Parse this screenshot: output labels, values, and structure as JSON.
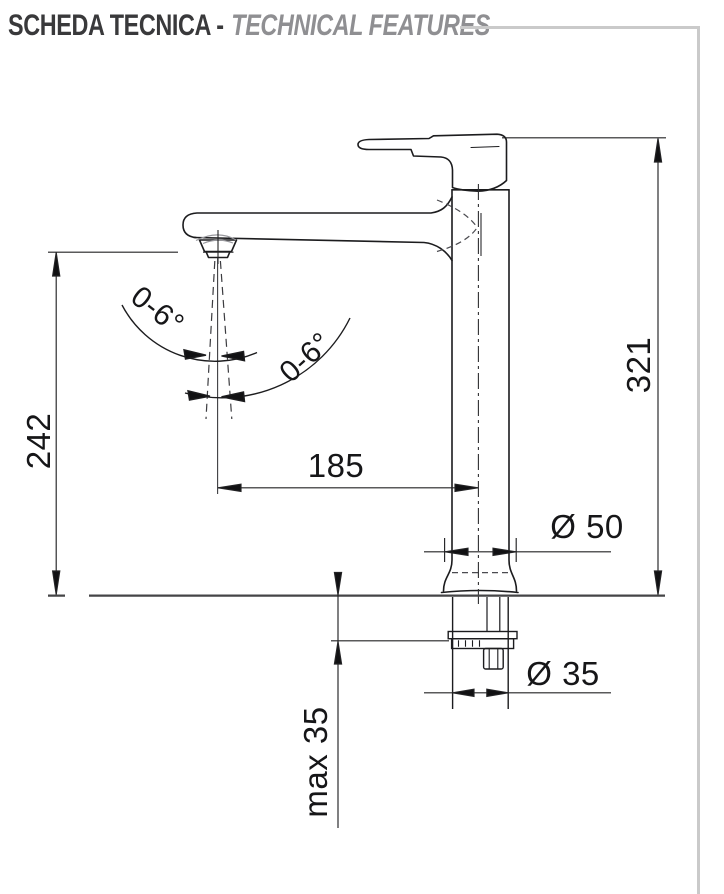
{
  "sheet": {
    "title_it": "SCHEDA TECNICA -",
    "title_en": "TECHNICAL FEATURES"
  },
  "drawing": {
    "dimensions": {
      "spout_height": "242",
      "total_height": "321",
      "spout_reach": "185",
      "base_diameter": "Ø 50",
      "shank_diameter": "Ø 35",
      "max_deck_thickness": "max 35",
      "aerator_tilt_left": "0-6°",
      "aerator_tilt_right": "0-6°"
    },
    "colors": {
      "object_line": "#1c1c1e",
      "dimension_line": "#232325",
      "frame_rule": "#cacaca",
      "title_primary": "#39393b",
      "title_secondary": "#8f8f92"
    }
  }
}
